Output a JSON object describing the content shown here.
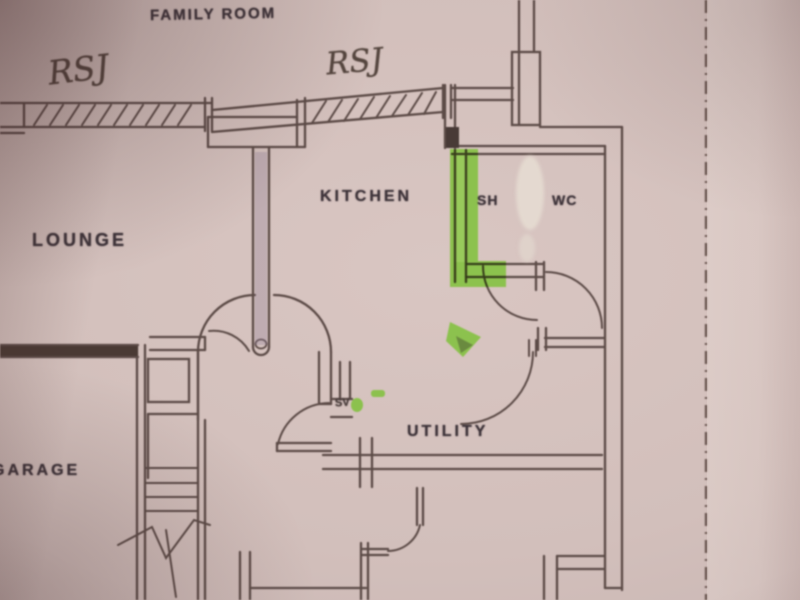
{
  "document": {
    "kind": "photograph of a hand-annotated architectural floor plan",
    "rooms": {
      "family_room": "FAMILY ROOM",
      "lounge": "LOUNGE",
      "kitchen": "KITCHEN",
      "shower": "SH",
      "wc": "WC",
      "utility": "UTILITY",
      "garage": "GARAGE"
    },
    "annotations": {
      "rsj_left": "RSJ",
      "rsj_right": "RSJ",
      "sv": "SV"
    },
    "colors": {
      "paper": "#d2bfbb",
      "pencil_line": "#5c4b47",
      "printed_text": "#3e343a",
      "highlighter_green": "#7fc139",
      "highlighter_purple": "#9a86a8",
      "correction_fluid": "#e6dcd2"
    }
  }
}
